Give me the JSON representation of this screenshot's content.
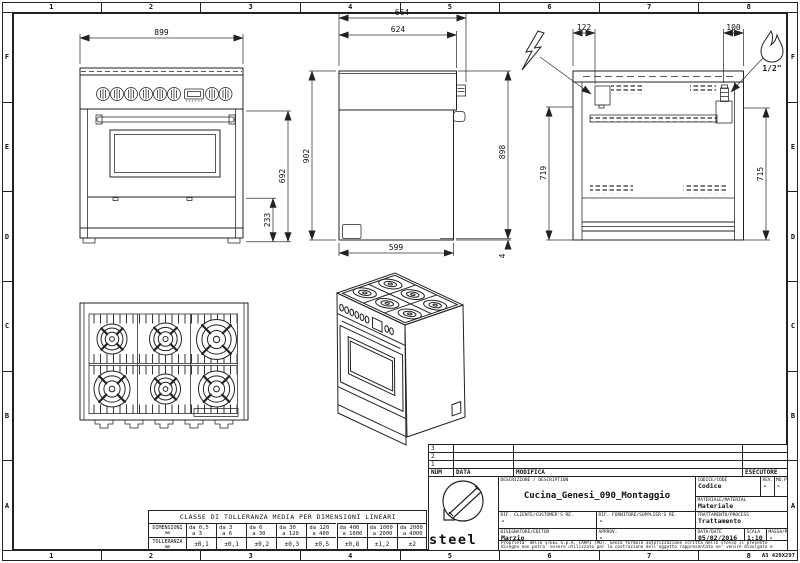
{
  "frame": {
    "cols": [
      "1",
      "2",
      "3",
      "4",
      "5",
      "6",
      "7",
      "8"
    ],
    "rows": [
      "F",
      "E",
      "D",
      "C",
      "B",
      "A"
    ],
    "sheet_size": "A3 420X297"
  },
  "dims": {
    "front_width": "899",
    "front_height": "692",
    "front_drawer": "233",
    "side_depth_total": "664",
    "side_depth_top": "624",
    "side_height": "902",
    "side_height_back": "898",
    "side_plinth": "4",
    "side_depth_base": "599",
    "rear_electric_x": "122",
    "rear_gas_x": "100",
    "rear_electric_h": "719",
    "rear_gas_h": "715",
    "gas_connection": "1/2\""
  },
  "tolerance_table": {
    "title": "CLASSE DI TOLLERANZA MEDIA PER DIMENSIONI LINEARI",
    "row1_label": "DIMENSIONI",
    "row1_unit": "mm",
    "row2_label": "TOLLERANZA",
    "row2_unit": "mm",
    "ranges": [
      {
        "from": "da 0,5",
        "to": "a  3"
      },
      {
        "from": "da 3",
        "to": "a  6"
      },
      {
        "from": "da 6",
        "to": "a  30"
      },
      {
        "from": "da 30",
        "to": "a  120"
      },
      {
        "from": "da 120",
        "to": "a  400"
      },
      {
        "from": "da 400",
        "to": "a  1000"
      },
      {
        "from": "da 1000",
        "to": "a  2000"
      },
      {
        "from": "da 2000",
        "to": "a  4000"
      }
    ],
    "tolerances": [
      "±0,1",
      "±0,1",
      "±0,2",
      "±0,3",
      "±0,5",
      "±0,8",
      "±1,2",
      "±2"
    ]
  },
  "title_block": {
    "revision_rows": [
      "3",
      "2",
      "1"
    ],
    "rev_headers": {
      "num": "NUM",
      "data": "DATA",
      "modifica": "MODIFICA",
      "esecutore": "ESECUTORE"
    },
    "logo": {
      "name": "steel",
      "tagline": "stile in cucina"
    },
    "description_label": "DESCRIZIONE / DESCRIPTION",
    "description": "Cucina_Genesi_090_Montaggio",
    "codice_label": "CODICE/CODE",
    "codice": "Codice",
    "rev_label": "REV.",
    "rev": "-",
    "mupi_label": "MU.PI.",
    "mupi": "-",
    "materiale_label": "MATERIALE/MATERIAL",
    "materiale": "Materiale",
    "rif_cliente_label": "RIF. CLIENTE/CUSTOMER'S RE.",
    "rif_cliente": "-",
    "rif_fornitore_label": "RIF. FORNITORE/SUPPLIER'S RE.",
    "rif_fornitore": "-",
    "trattamento_label": "TRATTAMENTO/PROCESS",
    "trattamento": "Trattamento",
    "disegnatore_label": "DISEGNATORE/EDITOR",
    "disegnatore": "Marzio",
    "approv_label": "APPROV.",
    "approv": "-",
    "data_label": "DATA/DATE",
    "data": "05/02/2016",
    "scala_label": "SCALA",
    "scala": "1:10",
    "massa_label": "MASSA/MASS kg",
    "massa": "-",
    "legal": "Proprieta' dello STEEL S.p.A. CARPI (MO). Senza formale autorizzazione scritta dello stesso il presente disegno non potra' essere utilizzato per la costruzione dell'oggetto rappresentato ne' venire divulgato e riprodotto, la proprietaria tutela i propri diritti a rigore di legge."
  }
}
